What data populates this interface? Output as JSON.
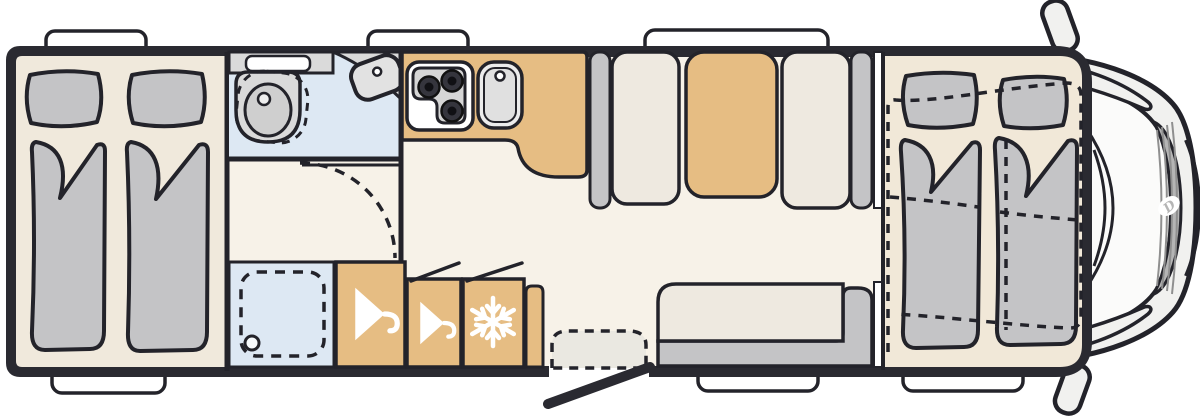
{
  "title": "Motorhome floor plan (top view)",
  "cab": {
    "logo_letter": "D"
  },
  "colors": {
    "line": "#23232a",
    "wall": "#2a2a31",
    "floor_living": "#f7f2e8",
    "floor_bedroom": "#f0e9dc",
    "floor_frontbed": "#f1e8d8",
    "wet": "#dde8f3",
    "wood": "#e6bd83",
    "furn_gray": "#c4c4c6",
    "cushion": "#eee9e0",
    "fixture": "#dadada",
    "white": "#ffffff",
    "body": "#f1f1ef",
    "grille": "#b5b5b5",
    "arch": "#eae8e1",
    "burner": "#35353d"
  },
  "windows": {
    "top_count": 3,
    "bottom_count": 3
  },
  "areas": {
    "rear_bedroom": {
      "name": "twin-single-beds",
      "features": [
        "pillow",
        "pillow",
        "duvet",
        "duvet"
      ]
    },
    "bathroom": {
      "name": "washroom",
      "features": [
        "toilet",
        "corner-washbasin",
        "vanity-shelf",
        "door-swing-arc"
      ]
    },
    "shower": {
      "name": "shower-cubicle",
      "features": [
        "drain"
      ]
    },
    "wardrobe_1": {
      "icon": "hanger"
    },
    "wardrobe_2": {
      "icon": "hanger"
    },
    "fridge": {
      "icon": "snowflake"
    },
    "kitchen": {
      "name": "kitchen-block",
      "features": [
        "three-burner-stove",
        "sink"
      ]
    },
    "dinette": {
      "name": "face-to-face-dinette",
      "features": [
        "bench-seat",
        "table",
        "bench-seat"
      ]
    },
    "entry": {
      "name": "entry-door",
      "features": [
        "step-arc",
        "open-door-leaf"
      ]
    },
    "sofa": {
      "name": "l-shaped-side-bench"
    },
    "front_bed": {
      "name": "drop-down-double-bed",
      "features": [
        "pillow",
        "pillow",
        "duvet",
        "duvet",
        "dashed-outline"
      ]
    },
    "cab_front": {
      "name": "driver-cab",
      "features": [
        "windshield",
        "wipers",
        "grille",
        "brand-logo",
        "mirror",
        "mirror"
      ]
    }
  }
}
